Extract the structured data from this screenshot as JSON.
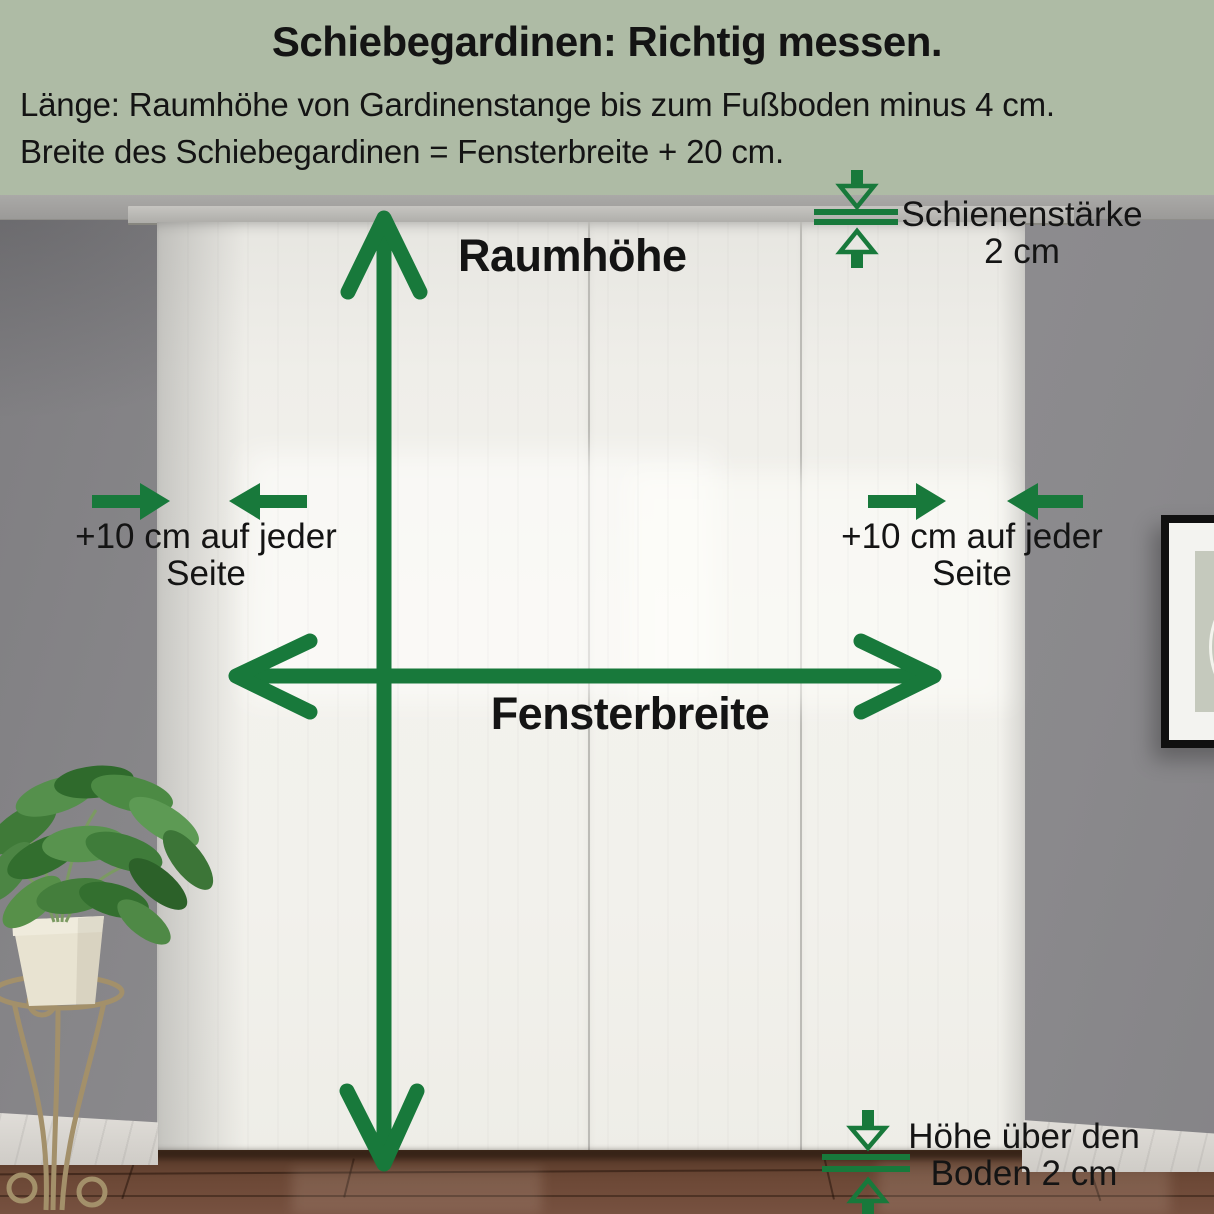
{
  "colors": {
    "header_bg": "#aebba5",
    "accent_green": "#18793b",
    "text": "#141414",
    "wall_gray": "#8c8b8e",
    "curtain_white": "#f2f1ec",
    "floor_brown": "#6c4836"
  },
  "header": {
    "title": "Schiebegardinen: Richtig messen.",
    "instructions": [
      "Länge: Raumhöhe von Gardinenstange bis zum Fußboden minus 4 cm.",
      "Breite des Schiebegardinen = Fensterbreite + 20 cm."
    ]
  },
  "diagram": {
    "room_height_label": "Raumhöhe",
    "window_width_label": "Fensterbreite",
    "side_left": {
      "line1": "+10 cm auf jeder",
      "line2": "Seite"
    },
    "side_right": {
      "line1": "+10 cm auf jeder",
      "line2": "Seite"
    },
    "rail": {
      "line1": "Schienenstärke",
      "line2": "2 cm"
    },
    "floor": {
      "line1": "Höhe über den",
      "line2": "Boden 2 cm"
    }
  },
  "icons": {
    "room_height": "vertical-double-arrow",
    "window_width": "horizontal-double-arrow",
    "side_extension": "converging-arrows",
    "rail_thickness": "pinch-arrows-with-lines",
    "floor_gap": "pinch-arrows-with-lines"
  }
}
